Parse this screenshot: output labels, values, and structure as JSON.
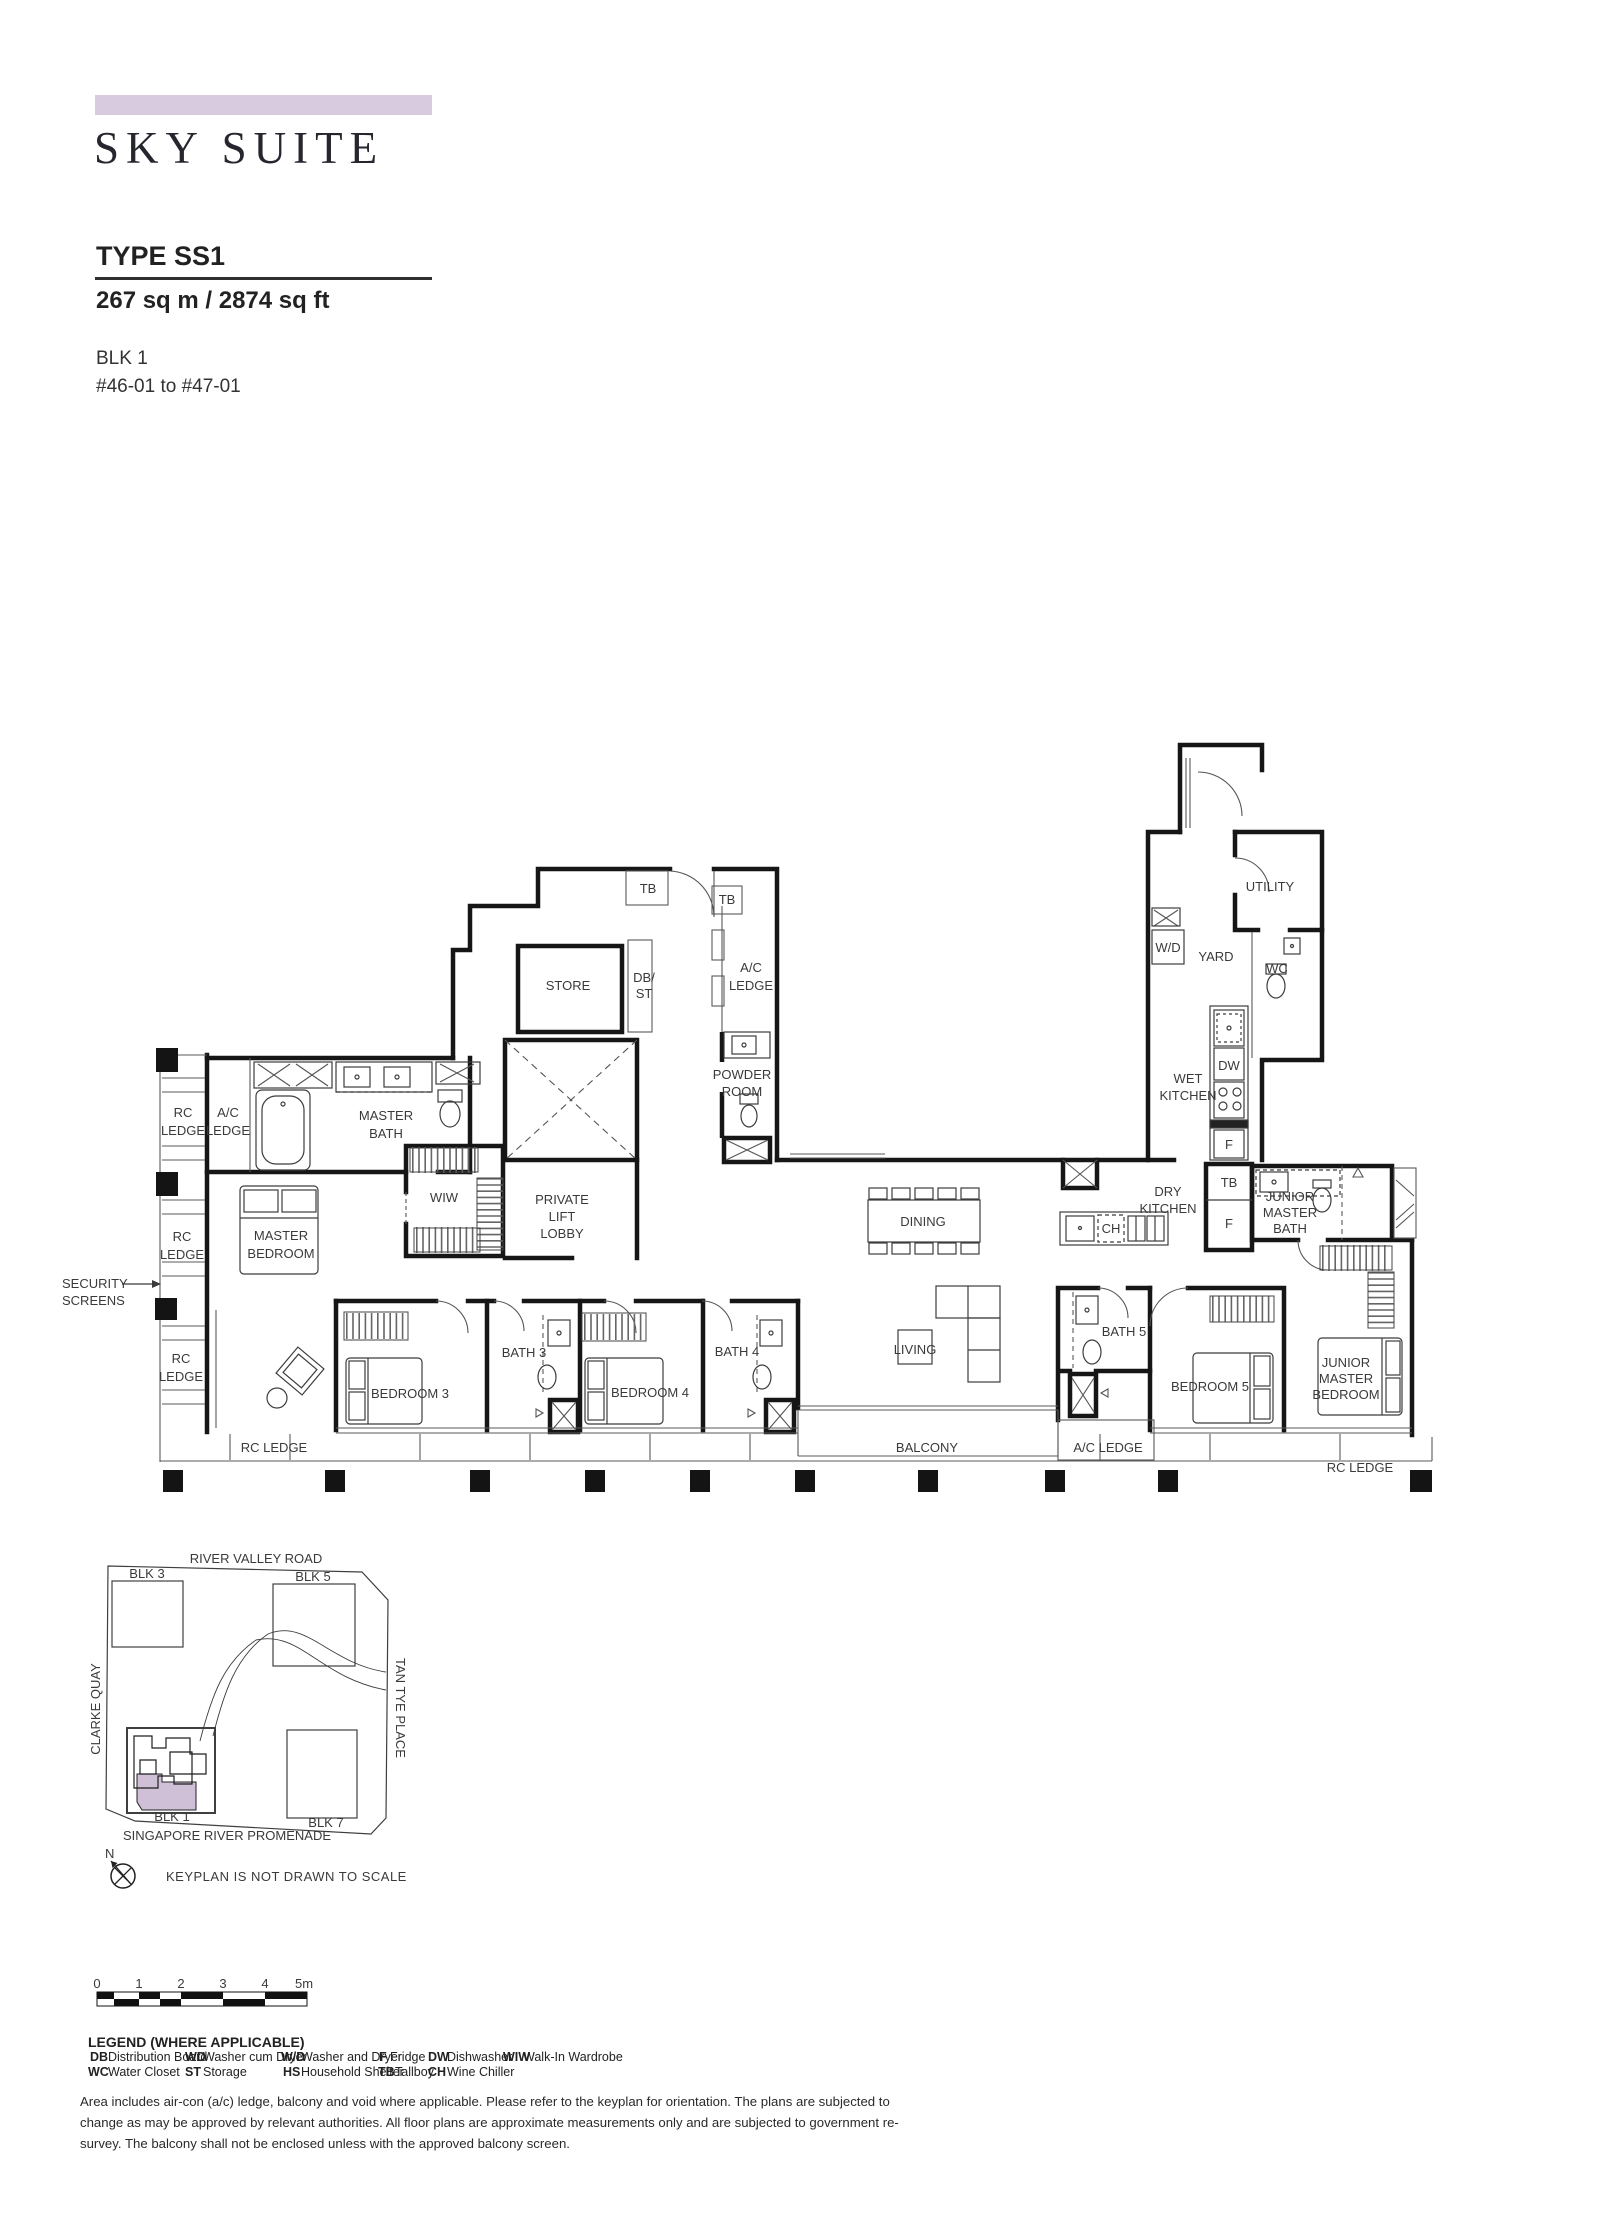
{
  "header": {
    "banner_color": "#d8cbdf",
    "title": "SKY SUITE",
    "type": "TYPE SS1",
    "area": "267 sq m / 2874 sq ft",
    "block": "BLK 1",
    "stack": "#46-01 to #47-01"
  },
  "floorplan": {
    "rooms": {
      "store": "STORE",
      "master_bath": [
        "MASTER",
        "BATH"
      ],
      "master_bedroom": [
        "MASTER",
        "BEDROOM"
      ],
      "wiw": "WIW",
      "private_lift_lobby": [
        "PRIVATE",
        "LIFT",
        "LOBBY"
      ],
      "powder_room": [
        "POWDER",
        "ROOM"
      ],
      "utility": "UTILITY",
      "yard": "YARD",
      "wc": "WC",
      "wet_kitchen": [
        "WET",
        "KITCHEN"
      ],
      "dry_kitchen": [
        "DRY",
        "KITCHEN"
      ],
      "dining": "DINING",
      "living": "LIVING",
      "junior_master_bath": [
        "JUNIOR",
        "MASTER",
        "BATH"
      ],
      "junior_master_bedroom": [
        "JUNIOR",
        "MASTER",
        "BEDROOM"
      ],
      "bedroom3": "BEDROOM 3",
      "bedroom4": "BEDROOM 4",
      "bedroom5": "BEDROOM 5",
      "bath3": "BATH 3",
      "bath4": "BATH 4",
      "bath5": "BATH 5",
      "balcony": "BALCONY"
    },
    "ledges": {
      "rc": [
        "RC",
        "LEDGE"
      ],
      "rc_inline": "RC LEDGE",
      "ac": [
        "A/C",
        "LEDGE"
      ],
      "ac_inline": "A/C LEDGE"
    },
    "fixtures": {
      "tb": "TB",
      "db": "DB/",
      "st": "ST",
      "wd": "W/D",
      "dw": "DW",
      "f": "F",
      "ch": "CH"
    },
    "security_screens": [
      "SECURITY",
      "SCREENS"
    ]
  },
  "keyplan": {
    "roads": {
      "river_valley": "RIVER VALLEY ROAD",
      "clarke_quay": "CLARKE QUAY",
      "tan_tye": "TAN TYE PLACE",
      "promenade": "SINGAPORE RIVER PROMENADE"
    },
    "blocks": {
      "blk1": "BLK 1",
      "blk3": "BLK 3",
      "blk5": "BLK 5",
      "blk7": "BLK 7"
    },
    "note": "KEYPLAN IS NOT DRAWN TO SCALE",
    "north": "N",
    "highlight_color": "#cfc0d8"
  },
  "scalebar": {
    "ticks": [
      "0",
      "1",
      "2",
      "3",
      "4",
      "5m"
    ]
  },
  "legend": {
    "heading": "LEGEND (WHERE APPLICABLE)",
    "rows": [
      [
        {
          "abbr": "DB",
          "term": "Distribution Board"
        },
        {
          "abbr": "WD",
          "term": "Washer cum Dryer"
        },
        {
          "abbr": "W/D",
          "term": "Washer and Dryer"
        },
        {
          "abbr": "F",
          "term": "Fridge"
        },
        {
          "abbr": "DW",
          "term": "Dishwasher"
        },
        {
          "abbr": "WIW",
          "term": "Walk-In Wardrobe"
        }
      ],
      [
        {
          "abbr": "WC",
          "term": "Water Closet"
        },
        {
          "abbr": "ST",
          "term": "Storage"
        },
        {
          "abbr": "HS",
          "term": "Household Shelter"
        },
        {
          "abbr": "TB",
          "term": "Tallboy"
        },
        {
          "abbr": "CH",
          "term": "Wine Chiller"
        }
      ]
    ]
  },
  "disclaimer": "Area includes air-con (a/c) ledge, balcony and void where applicable. Please refer to the keyplan for orientation. The plans are subjected to change as may be approved by relevant authorities. All floor plans are approximate measurements only and are subjected to government re-survey. The balcony shall not be enclosed unless with the approved balcony screen."
}
